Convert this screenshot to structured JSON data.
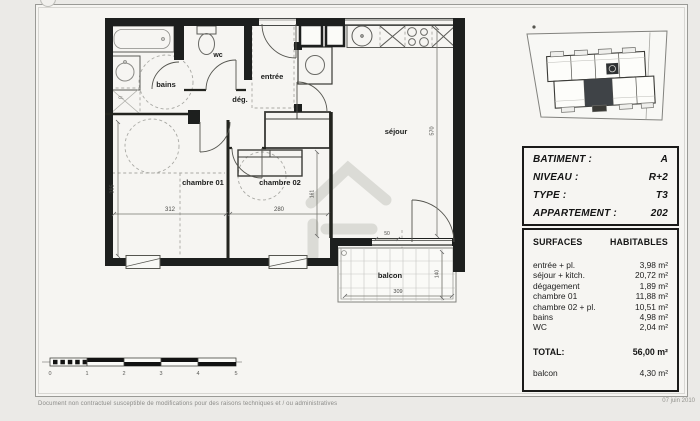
{
  "plan": {
    "room_labels": {
      "bains": "bains",
      "wc": "wc",
      "entree": "entrée",
      "degagement": "dég.",
      "chambre01": "chambre 01",
      "chambre02": "chambre 02",
      "sejour": "séjour",
      "balcon": "balcon",
      "closet": "CL"
    },
    "dimensions": {
      "chambre01_height": "385",
      "chambre01_width": "312",
      "chambre02_width": "280",
      "sejour_height": "570",
      "sejour_wall": "161",
      "door_offset": "50",
      "balcon_width": "309",
      "balcon_depth": "140"
    }
  },
  "scale_bar": {
    "ticks": [
      "0",
      "1",
      "2",
      "3",
      "4",
      "5"
    ]
  },
  "info": {
    "unit_box": {
      "rows": [
        {
          "label": "BATIMENT :",
          "value": "A"
        },
        {
          "label": "NIVEAU :",
          "value": "R+2"
        },
        {
          "label": "TYPE :",
          "value": "T3"
        },
        {
          "label": "APPARTEMENT :",
          "value": "202"
        }
      ]
    },
    "surfaces_box": {
      "header_left": "SURFACES",
      "header_right": "HABITABLES",
      "rows": [
        {
          "label": "entrée + pl.",
          "value": "3,98 m²"
        },
        {
          "label": "séjour + kitch.",
          "value": "20,72 m²"
        },
        {
          "label": "dégagement",
          "value": "1,89 m²"
        },
        {
          "label": "chambre 01",
          "value": "11,88 m²"
        },
        {
          "label": "chambre 02 + pl.",
          "value": "10,51 m²"
        },
        {
          "label": "bains",
          "value": "4,98 m²"
        },
        {
          "label": "WC",
          "value": "2,04 m²"
        }
      ],
      "total": {
        "label": "TOTAL:",
        "value": "56,00 m²"
      },
      "balcon": {
        "label": "balcon",
        "value": "4,30 m²"
      }
    }
  },
  "footer": {
    "disclaimer": "Document non contractuel susceptible de modifications pour des raisons techniques et / ou administratives",
    "date": "07 juin 2010"
  },
  "colors": {
    "wall": "#1d1f1e",
    "highlight_unit": "#3f4347",
    "paper": "#f6f5f2"
  }
}
